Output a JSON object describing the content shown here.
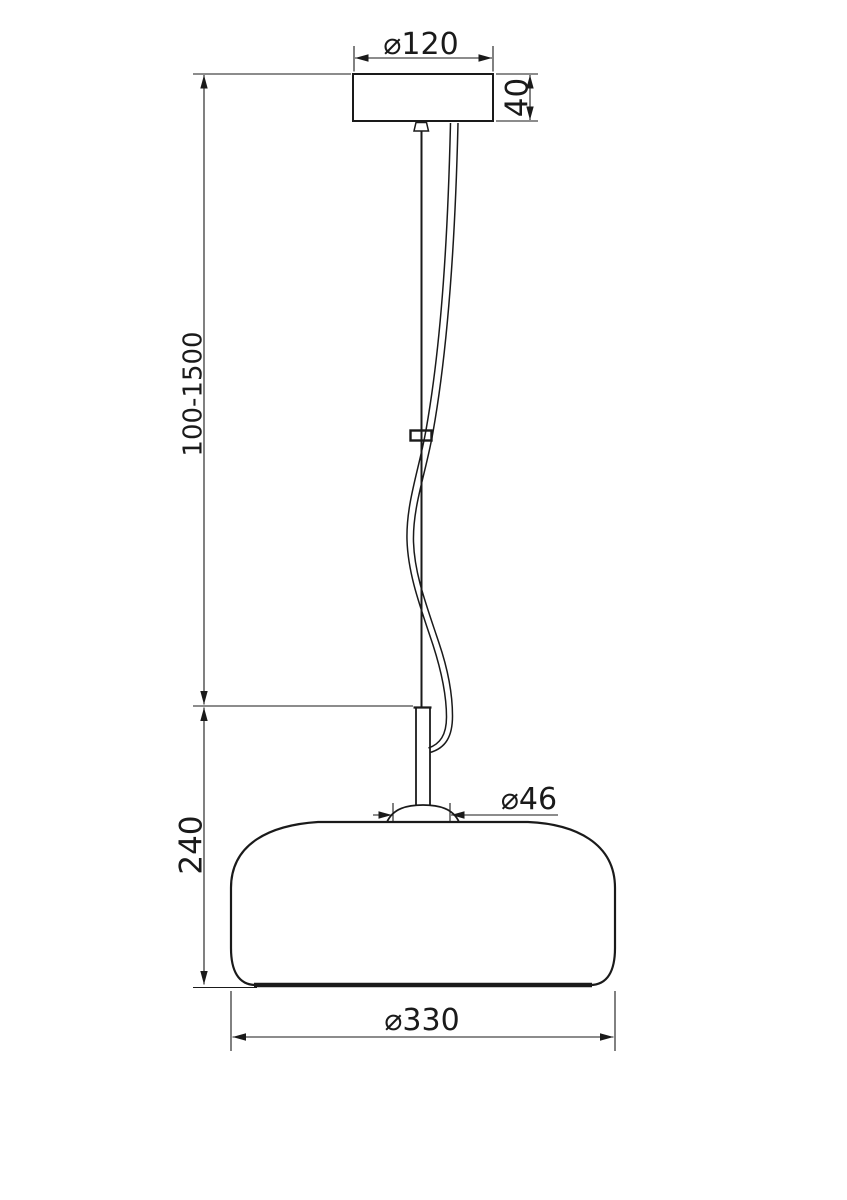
{
  "drawing": {
    "kind": "pendant lamp installation dimension drawing",
    "background_color": "#ffffff",
    "line_color": "#1a1a1a",
    "labels": {
      "canopy_diameter": "⌀120",
      "canopy_height": "40",
      "suspension_length": "100-1500",
      "shade_height": "240",
      "stem_diameter": "⌀46",
      "shade_diameter": "⌀330"
    }
  }
}
